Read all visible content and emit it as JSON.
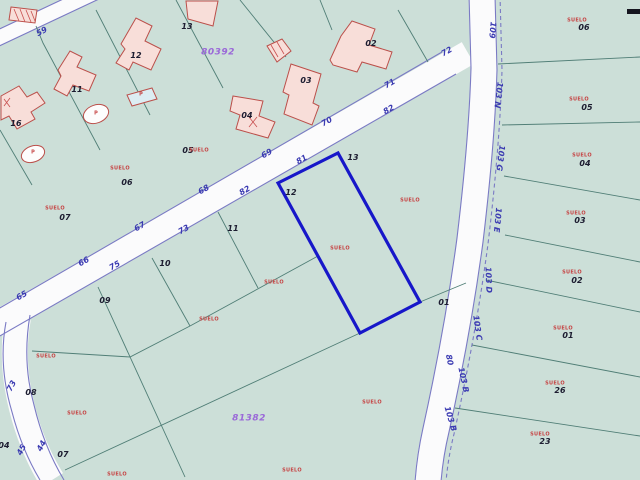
{
  "map": {
    "title": "cadastral-parcel-map",
    "land_use_label": "SUELO",
    "block_numbers": [
      "80392",
      "81382"
    ],
    "selected_parcel": "12",
    "colors": {
      "parcel_fill": "#ccdfd8",
      "road_fill": "#fbfbfc",
      "road_edge": "#7a7ac4",
      "boundary_line": "#507e76",
      "selected_outline": "#1717c9",
      "building_fill": "#f8ded9",
      "building_outline": "#bb4f4a",
      "pool_fill": "#dcedf3",
      "text_black": "#1c1c30",
      "text_red": "#c64545",
      "text_blue": "#3b3bb2",
      "text_purple": "#9a68d8"
    },
    "labels": [
      {
        "t": "65",
        "x": 22,
        "y": 296,
        "r": -30,
        "k": "road"
      },
      {
        "t": "66",
        "x": 84,
        "y": 262,
        "r": -30,
        "k": "road"
      },
      {
        "t": "67",
        "x": 140,
        "y": 227,
        "r": -30,
        "k": "road"
      },
      {
        "t": "68",
        "x": 204,
        "y": 190,
        "r": -30,
        "k": "road"
      },
      {
        "t": "69",
        "x": 267,
        "y": 154,
        "r": -30,
        "k": "road"
      },
      {
        "t": "70",
        "x": 327,
        "y": 122,
        "r": -30,
        "k": "road"
      },
      {
        "t": "71",
        "x": 390,
        "y": 84,
        "r": -30,
        "k": "road"
      },
      {
        "t": "72",
        "x": 447,
        "y": 52,
        "r": -30,
        "k": "road"
      },
      {
        "t": "75",
        "x": 115,
        "y": 266,
        "r": -30,
        "k": "road"
      },
      {
        "t": "73",
        "x": 184,
        "y": 230,
        "r": -30,
        "k": "road"
      },
      {
        "t": "82",
        "x": 245,
        "y": 191,
        "r": -30,
        "k": "road"
      },
      {
        "t": "81",
        "x": 302,
        "y": 160,
        "r": -30,
        "k": "road"
      },
      {
        "t": "82",
        "x": 389,
        "y": 110,
        "r": -30,
        "k": "road"
      },
      {
        "t": "59",
        "x": 42,
        "y": 32,
        "r": -28,
        "k": "road"
      },
      {
        "t": "73",
        "x": 12,
        "y": 386,
        "r": -62,
        "k": "road"
      },
      {
        "t": "45",
        "x": 22,
        "y": 450,
        "r": -62,
        "k": "road"
      },
      {
        "t": "44",
        "x": 42,
        "y": 446,
        "r": -62,
        "k": "road"
      },
      {
        "t": "109",
        "x": 492,
        "y": 30,
        "r": 95,
        "k": "road"
      },
      {
        "t": "103 N",
        "x": 498,
        "y": 95,
        "r": 97,
        "k": "road"
      },
      {
        "t": "103 G",
        "x": 500,
        "y": 158,
        "r": 97,
        "k": "road"
      },
      {
        "t": "103 E",
        "x": 497,
        "y": 220,
        "r": 95,
        "k": "road"
      },
      {
        "t": "103 D",
        "x": 488,
        "y": 280,
        "r": 88,
        "k": "road"
      },
      {
        "t": "103 C",
        "x": 477,
        "y": 328,
        "r": 82,
        "k": "road"
      },
      {
        "t": "103 B",
        "x": 463,
        "y": 380,
        "r": 78,
        "k": "road"
      },
      {
        "t": "103 B",
        "x": 450,
        "y": 419,
        "r": 74,
        "k": "road"
      },
      {
        "t": "80",
        "x": 449,
        "y": 360,
        "r": 78,
        "k": "road"
      },
      {
        "t": "16",
        "x": 16,
        "y": 124,
        "r": 0,
        "k": "num"
      },
      {
        "t": "11",
        "x": 77,
        "y": 90,
        "r": 0,
        "k": "num"
      },
      {
        "t": "12",
        "x": 136,
        "y": 56,
        "r": 0,
        "k": "num"
      },
      {
        "t": "13",
        "x": 187,
        "y": 27,
        "r": 0,
        "k": "num"
      },
      {
        "t": "03",
        "x": 306,
        "y": 81,
        "r": 0,
        "k": "num"
      },
      {
        "t": "04",
        "x": 247,
        "y": 116,
        "r": 0,
        "k": "num"
      },
      {
        "t": "02",
        "x": 371,
        "y": 44,
        "r": 0,
        "k": "num"
      },
      {
        "t": "05",
        "x": 188,
        "y": 151,
        "r": 0,
        "k": "num"
      },
      {
        "t": "06",
        "x": 127,
        "y": 183,
        "r": 0,
        "k": "num"
      },
      {
        "t": "07",
        "x": 65,
        "y": 218,
        "r": 0,
        "k": "num"
      },
      {
        "t": "09",
        "x": 105,
        "y": 301,
        "r": 0,
        "k": "num"
      },
      {
        "t": "10",
        "x": 165,
        "y": 264,
        "r": 0,
        "k": "num"
      },
      {
        "t": "11",
        "x": 233,
        "y": 229,
        "r": 0,
        "k": "num"
      },
      {
        "t": "12",
        "x": 291,
        "y": 193,
        "r": 0,
        "k": "num"
      },
      {
        "t": "13",
        "x": 353,
        "y": 158,
        "r": 0,
        "k": "num"
      },
      {
        "t": "01",
        "x": 444,
        "y": 303,
        "r": 0,
        "k": "num"
      },
      {
        "t": "08",
        "x": 31,
        "y": 393,
        "r": 0,
        "k": "num"
      },
      {
        "t": "07",
        "x": 63,
        "y": 455,
        "r": 0,
        "k": "num"
      },
      {
        "t": "04",
        "x": 4,
        "y": 446,
        "r": 0,
        "k": "num"
      },
      {
        "t": "06",
        "x": 584,
        "y": 28,
        "r": 0,
        "k": "num"
      },
      {
        "t": "05",
        "x": 587,
        "y": 108,
        "r": 0,
        "k": "num"
      },
      {
        "t": "04",
        "x": 585,
        "y": 164,
        "r": 0,
        "k": "num"
      },
      {
        "t": "03",
        "x": 580,
        "y": 221,
        "r": 0,
        "k": "num"
      },
      {
        "t": "02",
        "x": 577,
        "y": 281,
        "r": 0,
        "k": "num"
      },
      {
        "t": "01",
        "x": 568,
        "y": 336,
        "r": 0,
        "k": "num"
      },
      {
        "t": "26",
        "x": 560,
        "y": 391,
        "r": 0,
        "k": "num"
      },
      {
        "t": "23",
        "x": 545,
        "y": 442,
        "r": 0,
        "k": "num"
      },
      {
        "t": "SUELO",
        "x": 120,
        "y": 169,
        "r": 0,
        "k": "suelo"
      },
      {
        "t": "SUELO",
        "x": 199,
        "y": 151,
        "r": 0,
        "k": "suelo"
      },
      {
        "t": "SUELO",
        "x": 55,
        "y": 209,
        "r": 0,
        "k": "suelo"
      },
      {
        "t": "SUELO",
        "x": 340,
        "y": 249,
        "r": 0,
        "k": "suelo"
      },
      {
        "t": "SUELO",
        "x": 410,
        "y": 201,
        "r": 0,
        "k": "suelo"
      },
      {
        "t": "SUELO",
        "x": 274,
        "y": 283,
        "r": 0,
        "k": "suelo"
      },
      {
        "t": "SUELO",
        "x": 209,
        "y": 320,
        "r": 0,
        "k": "suelo"
      },
      {
        "t": "SUELO",
        "x": 46,
        "y": 357,
        "r": 0,
        "k": "suelo"
      },
      {
        "t": "SUELO",
        "x": 77,
        "y": 414,
        "r": 0,
        "k": "suelo"
      },
      {
        "t": "SUELO",
        "x": 117,
        "y": 475,
        "r": 0,
        "k": "suelo"
      },
      {
        "t": "SUELO",
        "x": 292,
        "y": 471,
        "r": 0,
        "k": "suelo"
      },
      {
        "t": "SUELO",
        "x": 372,
        "y": 403,
        "r": 0,
        "k": "suelo"
      },
      {
        "t": "SUELO",
        "x": 577,
        "y": 21,
        "r": 0,
        "k": "suelo"
      },
      {
        "t": "SUELO",
        "x": 579,
        "y": 100,
        "r": 0,
        "k": "suelo"
      },
      {
        "t": "SUELO",
        "x": 582,
        "y": 156,
        "r": 0,
        "k": "suelo"
      },
      {
        "t": "SUELO",
        "x": 576,
        "y": 214,
        "r": 0,
        "k": "suelo"
      },
      {
        "t": "SUELO",
        "x": 572,
        "y": 273,
        "r": 0,
        "k": "suelo"
      },
      {
        "t": "SUELO",
        "x": 563,
        "y": 329,
        "r": 0,
        "k": "suelo"
      },
      {
        "t": "SUELO",
        "x": 555,
        "y": 384,
        "r": 0,
        "k": "suelo"
      },
      {
        "t": "SUELO",
        "x": 540,
        "y": 435,
        "r": 0,
        "k": "suelo"
      },
      {
        "t": "80392",
        "x": 218,
        "y": 53,
        "r": 0,
        "k": "block"
      },
      {
        "t": "81382",
        "x": 249,
        "y": 419,
        "r": 0,
        "k": "block"
      },
      {
        "t": "P",
        "x": 141,
        "y": 95,
        "r": 0,
        "k": "pmark"
      },
      {
        "t": "P",
        "x": 96,
        "y": 114,
        "r": 0,
        "k": "pmark"
      },
      {
        "t": "P",
        "x": 33,
        "y": 153,
        "r": 0,
        "k": "pmark"
      }
    ]
  }
}
